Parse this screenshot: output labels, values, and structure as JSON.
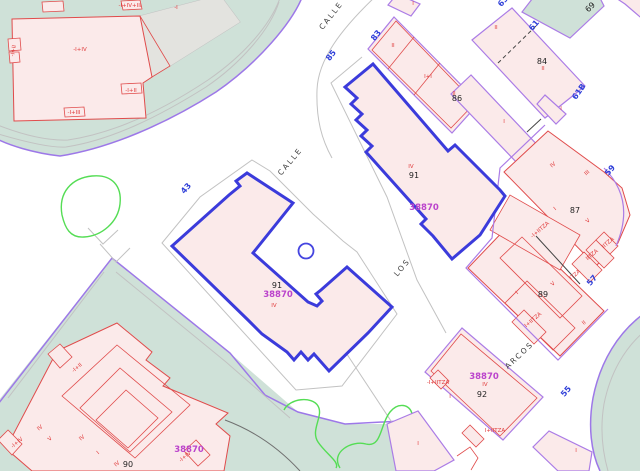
{
  "map": {
    "type": "cadastral-parcel-map",
    "selected_parcel_id": "38870",
    "street_names_visible": [
      "CALLE",
      "LOS",
      "ARCOS"
    ],
    "colors": {
      "background": "#ffffff",
      "green_area": "#cfe1d8",
      "building_fill": "#fbeaea",
      "building_outline": "#e04b4b",
      "parcel_outline": "#ab7ce6",
      "selected_outline": "#3b3bdb",
      "parcel_ref_text": "#bb44cc",
      "street_number_text": "#2f3fd8",
      "contour_green": "#55dd55",
      "boundary_violet": "#9d78e8",
      "grey_line": "#c2c2c2"
    }
  },
  "labels": {
    "street_names": [
      {
        "text": "CALLE",
        "x": 333,
        "y": 17,
        "rot": -52
      },
      {
        "text": "CALLE",
        "x": 292,
        "y": 163,
        "rot": -50
      },
      {
        "text": "LOS",
        "x": 404,
        "y": 269,
        "rot": -50
      },
      {
        "text": "ARCOS",
        "x": 521,
        "y": 357,
        "rot": -43
      }
    ],
    "street_numbers": [
      {
        "text": "43",
        "x": 188,
        "y": 190,
        "rot": -50
      },
      {
        "text": "85",
        "x": 333,
        "y": 57,
        "rot": -52
      },
      {
        "text": "83",
        "x": 378,
        "y": 37,
        "rot": -52
      },
      {
        "text": "63",
        "x": 505,
        "y": 3,
        "rot": -50
      },
      {
        "text": "61",
        "x": 536,
        "y": 27,
        "rot": -50
      },
      {
        "text": "61B",
        "x": 581,
        "y": 93,
        "rot": -55
      },
      {
        "text": "59",
        "x": 612,
        "y": 172,
        "rot": -50
      },
      {
        "text": "57",
        "x": 594,
        "y": 282,
        "rot": -50
      },
      {
        "text": "55",
        "x": 568,
        "y": 393,
        "rot": -50
      }
    ],
    "parcel_refs": [
      {
        "text": "38870",
        "x": 424,
        "y": 210,
        "rot": 0
      },
      {
        "text": "38870",
        "x": 278,
        "y": 297,
        "rot": 0
      },
      {
        "text": "38870",
        "x": 484,
        "y": 379,
        "rot": 0
      },
      {
        "text": "38870",
        "x": 189,
        "y": 452,
        "rot": 0
      }
    ],
    "house_numbers": [
      {
        "text": "91",
        "x": 414,
        "y": 178,
        "rot": 0
      },
      {
        "text": "91",
        "x": 277,
        "y": 288,
        "rot": 0
      },
      {
        "text": "86",
        "x": 457,
        "y": 101,
        "rot": 0
      },
      {
        "text": "84",
        "x": 542,
        "y": 64,
        "rot": 0
      },
      {
        "text": "87",
        "x": 575,
        "y": 213,
        "rot": 0
      },
      {
        "text": "89",
        "x": 543,
        "y": 297,
        "rot": 0
      },
      {
        "text": "92",
        "x": 482,
        "y": 397,
        "rot": 0
      },
      {
        "text": "90",
        "x": 128,
        "y": 467,
        "rot": 0
      },
      {
        "text": "69",
        "x": 592,
        "y": 9,
        "rot": -45
      }
    ],
    "floor_codes": [
      {
        "text": "-I+IV",
        "x": 80,
        "y": 51,
        "rot": 0
      },
      {
        "text": "-I+IV+III",
        "x": 130,
        "y": 7,
        "rot": 0
      },
      {
        "text": "-I",
        "x": 176,
        "y": 9,
        "rot": 0
      },
      {
        "text": "-I+II",
        "x": 15,
        "y": 51,
        "rot": -80
      },
      {
        "text": "-I+II",
        "x": 131,
        "y": 92,
        "rot": 0
      },
      {
        "text": "-I+III",
        "x": 74,
        "y": 114,
        "rot": 0
      },
      {
        "text": "I",
        "x": 413,
        "y": 5,
        "rot": 0
      },
      {
        "text": "II",
        "x": 393,
        "y": 47,
        "rot": 0
      },
      {
        "text": "I+I",
        "x": 428,
        "y": 78,
        "rot": 0
      },
      {
        "text": "II",
        "x": 454,
        "y": 95,
        "rot": 0
      },
      {
        "text": "II",
        "x": 496,
        "y": 29,
        "rot": 0
      },
      {
        "text": "II",
        "x": 543,
        "y": 70,
        "rot": 0
      },
      {
        "text": "I",
        "x": 561,
        "y": 110,
        "rot": 0
      },
      {
        "text": "I",
        "x": 504,
        "y": 123,
        "rot": 0
      },
      {
        "text": "IV",
        "x": 554,
        "y": 166,
        "rot": -40
      },
      {
        "text": "III",
        "x": 588,
        "y": 174,
        "rot": -40
      },
      {
        "text": "IV",
        "x": 411,
        "y": 168,
        "rot": 0
      },
      {
        "text": "IV",
        "x": 274,
        "y": 307,
        "rot": 0
      },
      {
        "text": "I",
        "x": 556,
        "y": 210,
        "rot": -40
      },
      {
        "text": "V",
        "x": 589,
        "y": 222,
        "rot": -40
      },
      {
        "text": "-I+IITZA",
        "x": 541,
        "y": 231,
        "rot": -40
      },
      {
        "text": "IITZA",
        "x": 609,
        "y": 244,
        "rot": -40
      },
      {
        "text": "IITZA",
        "x": 593,
        "y": 256,
        "rot": -40
      },
      {
        "text": "ITZA",
        "x": 576,
        "y": 276,
        "rot": -40
      },
      {
        "text": "V",
        "x": 554,
        "y": 285,
        "rot": -40
      },
      {
        "text": "I",
        "x": 518,
        "y": 294,
        "rot": -40
      },
      {
        "text": "I+IITZA",
        "x": 534,
        "y": 321,
        "rot": -40
      },
      {
        "text": "II",
        "x": 585,
        "y": 324,
        "rot": -40
      },
      {
        "text": "-I+IITZA",
        "x": 438,
        "y": 384,
        "rot": 0
      },
      {
        "text": "IV",
        "x": 485,
        "y": 386,
        "rot": 0
      },
      {
        "text": "I",
        "x": 450,
        "y": 398,
        "rot": 0
      },
      {
        "text": "I+IITZA",
        "x": 495,
        "y": 432,
        "rot": 0
      },
      {
        "text": "I",
        "x": 418,
        "y": 445,
        "rot": 0
      },
      {
        "text": "I",
        "x": 576,
        "y": 452,
        "rot": 0
      },
      {
        "text": "-I+II",
        "x": 78,
        "y": 369,
        "rot": -40
      },
      {
        "text": "-I+IV",
        "x": 18,
        "y": 444,
        "rot": -40
      },
      {
        "text": "IV",
        "x": 41,
        "y": 429,
        "rot": -40
      },
      {
        "text": "V",
        "x": 51,
        "y": 440,
        "rot": -40
      },
      {
        "text": "IV",
        "x": 83,
        "y": 439,
        "rot": -40
      },
      {
        "text": "I",
        "x": 99,
        "y": 454,
        "rot": -40
      },
      {
        "text": "IV",
        "x": 118,
        "y": 465,
        "rot": -40
      },
      {
        "text": "-I+IV",
        "x": 186,
        "y": 458,
        "rot": -40
      }
    ]
  }
}
